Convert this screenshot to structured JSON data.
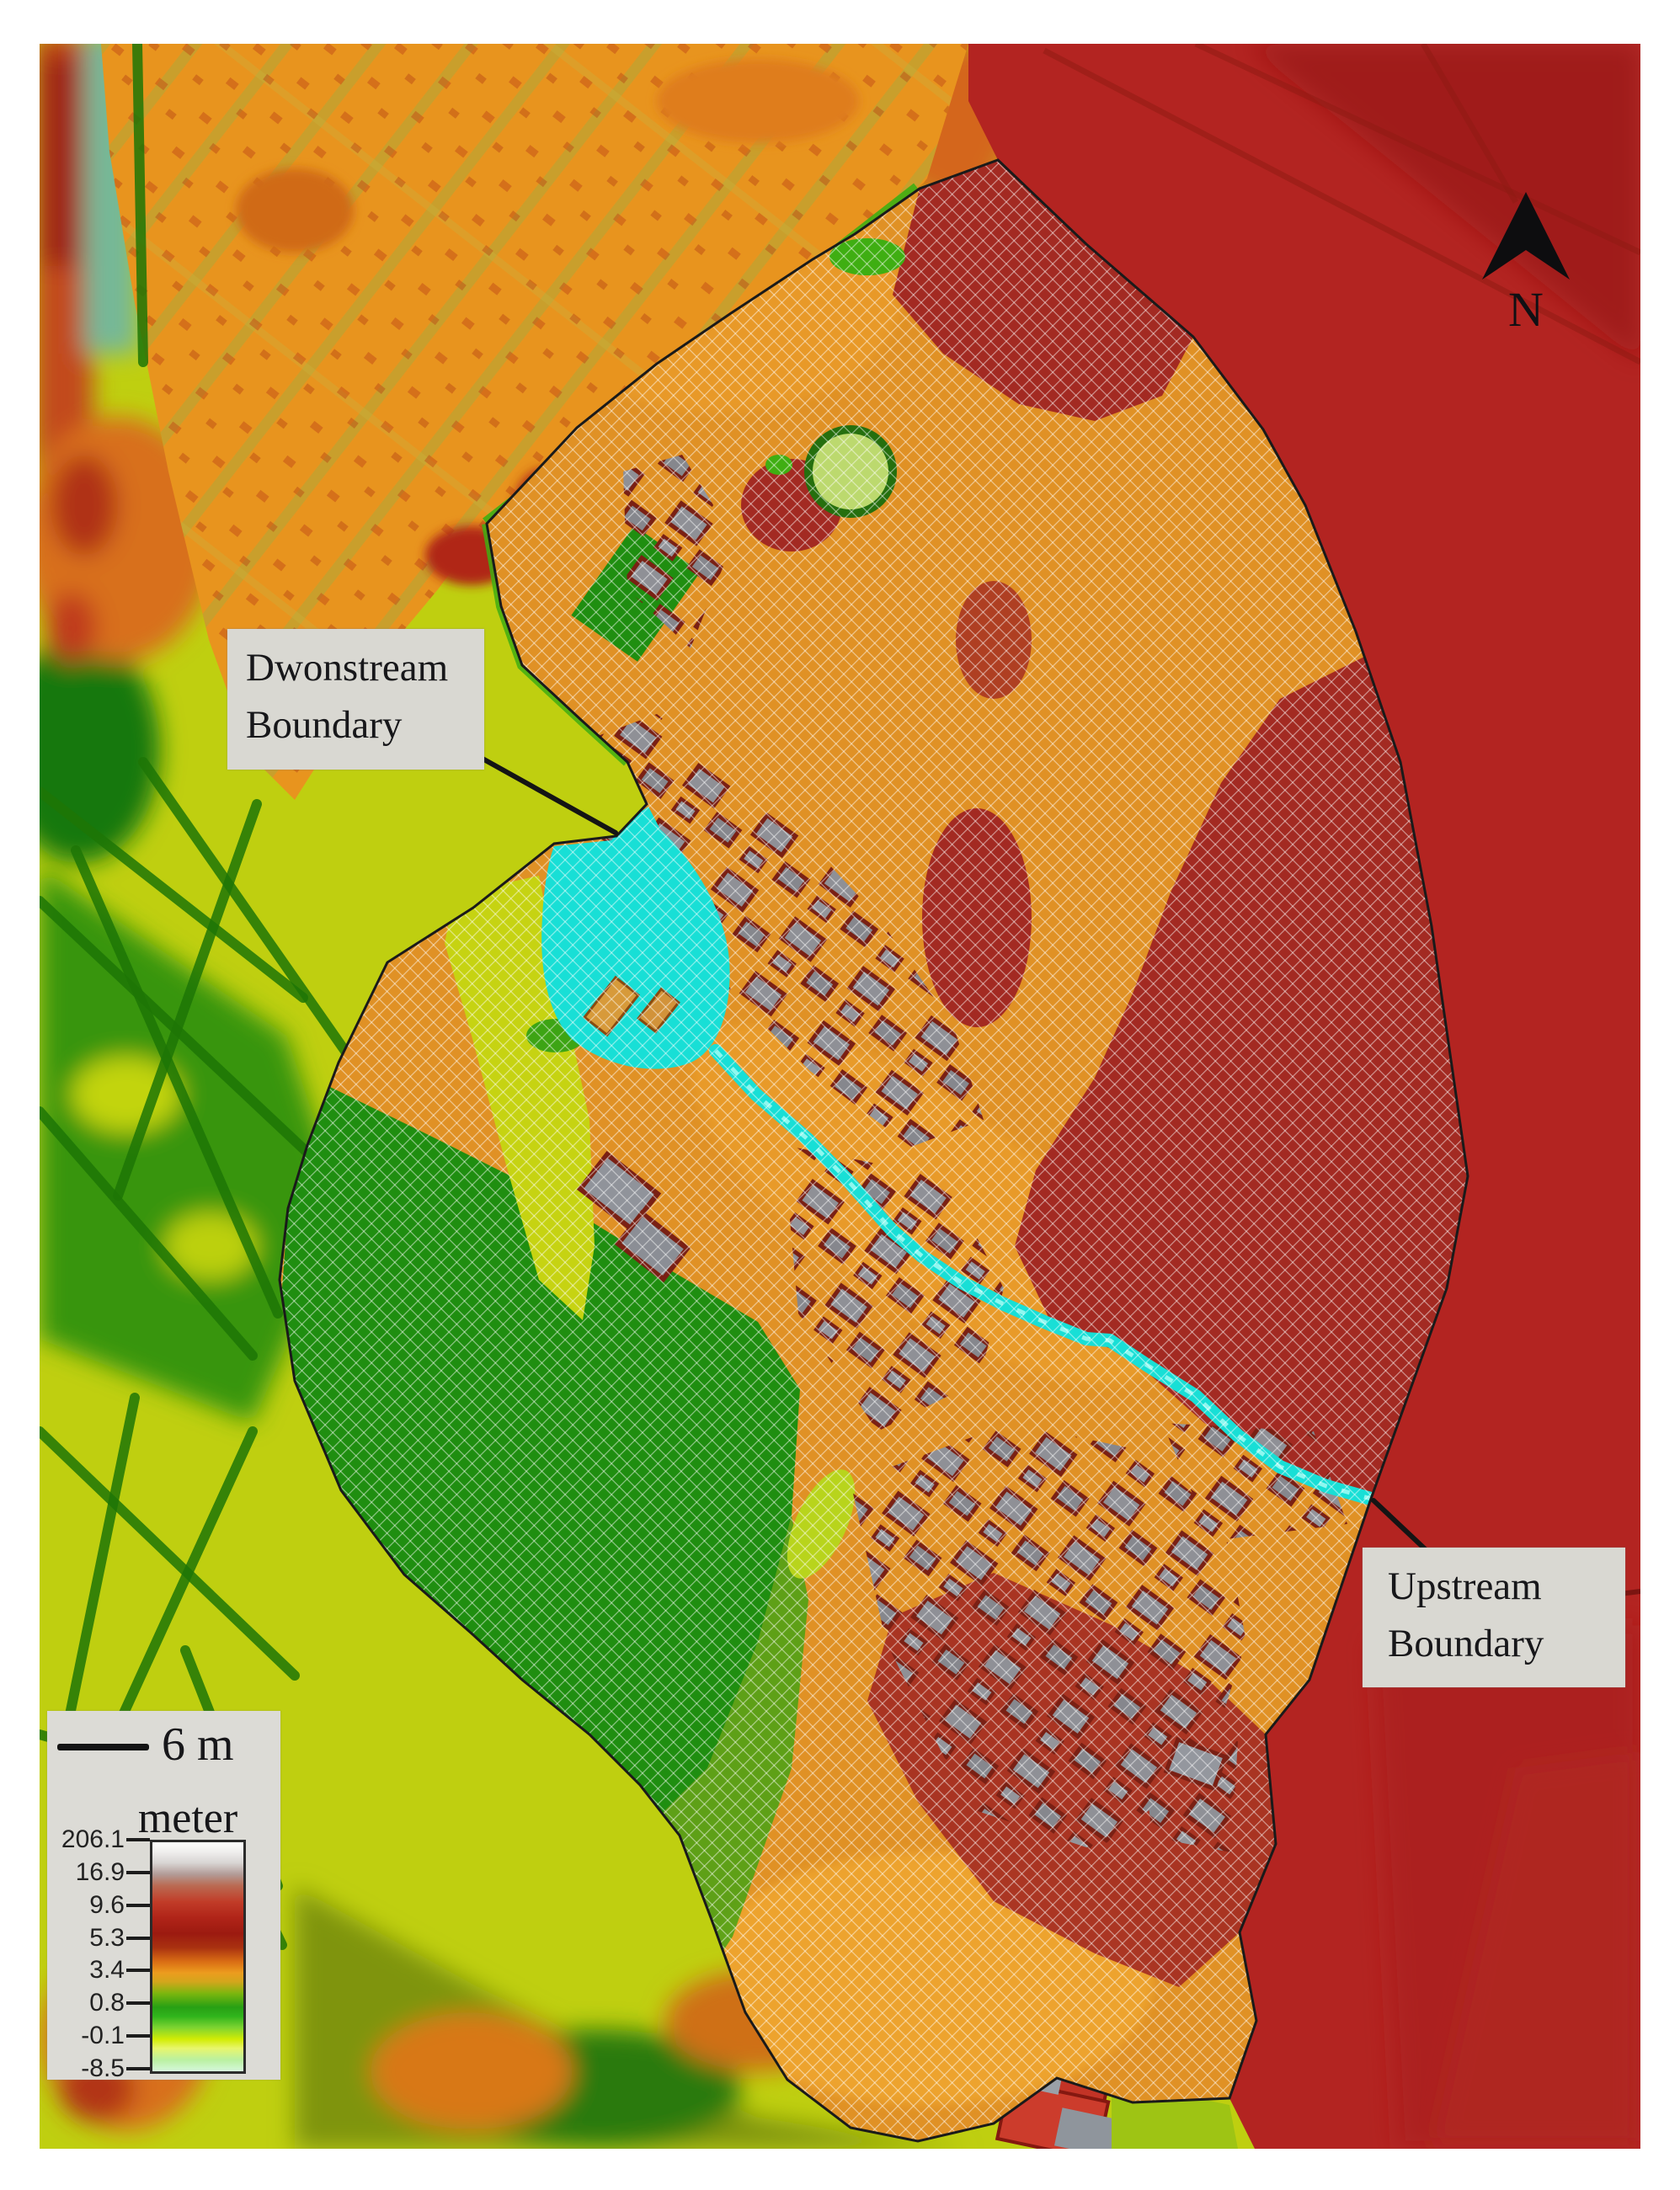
{
  "figure_labels": {
    "downstream_line1": "Dwonstream",
    "downstream_line2": "Boundary",
    "upstream_line1": "Upstream",
    "upstream_line2": "Boundary",
    "north": "N"
  },
  "scale_bar": {
    "label": "6 m"
  },
  "legend": {
    "title": "meter",
    "unit": "meter",
    "ticks": [
      "206.1",
      "16.9",
      "9.6",
      "5.3",
      "3.4",
      "0.8",
      "-0.1",
      "-8.5"
    ]
  },
  "map": {
    "features": {
      "mesh_domain": "crosshatched computational mesh",
      "stream": "cyan stream channel",
      "pond": "cyan detention pond",
      "round_pond": "circular pond",
      "buildings": "gray building footprints"
    },
    "colors": {
      "water_cyan": "#18dfd6",
      "terrain_orange": "#e8941e",
      "terrain_red": "#b32421",
      "terrain_yellow_green": "#bfcf10",
      "terrain_dark_green": "#1d7d06",
      "mesh_red": "#a32a22",
      "building_gray": "#8f9096",
      "label_background": "#d9d8d2",
      "legend_background": "#dcdbd6"
    }
  }
}
